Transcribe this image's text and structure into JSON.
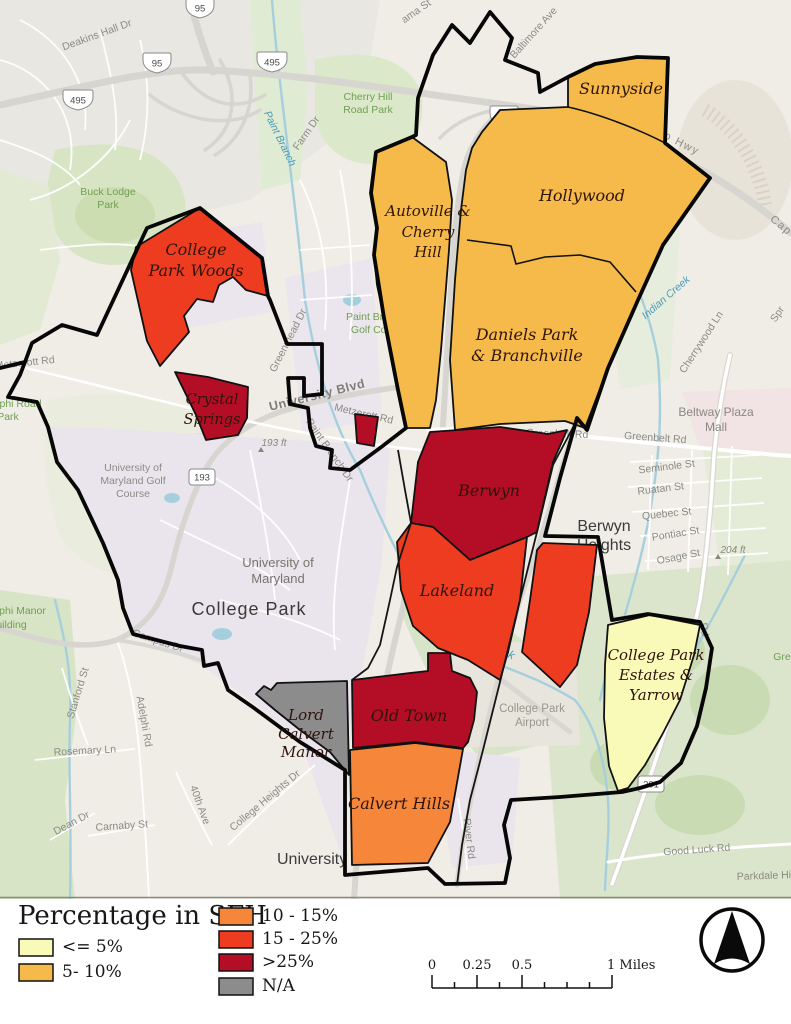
{
  "colors": {
    "cat_le5": "#FAFAB8",
    "cat_5_10": "#F6BA4A",
    "cat_10_15": "#F6873A",
    "cat_15_25": "#EE3C20",
    "cat_gt25": "#B30E26",
    "cat_na": "#8C8C8C"
  },
  "neighborhoods": {
    "sunnyside": "Sunnyside",
    "hollywood": "Hollywood",
    "autoville": [
      "Autoville &",
      "Cherry",
      "Hill"
    ],
    "daniels": [
      "Daniels Park",
      "& Branchville"
    ],
    "cp_woods": [
      "College",
      "Park Woods"
    ],
    "crystal_springs": [
      "Crystal",
      "Springs"
    ],
    "berwyn": "Berwyn",
    "lakeland": "Lakeland",
    "cpe_yarrow": [
      "College Park",
      "Estates &",
      "Yarrow"
    ],
    "lord_calvert": [
      "Lord",
      "Calvert",
      "Manor"
    ],
    "old_town": "Old Town",
    "calvert_hills": "Calvert Hills"
  },
  "roads": {
    "deakins": "Deakins Hall Dr",
    "farm": "Farm Dr",
    "baltimore": "Baltimore Ave",
    "ama_st": "ama St",
    "cap_belt": "Cap Belt Ol So Hwy",
    "cap": "Cap",
    "metzerott": "Metzerott Rd",
    "university_blvd": "University Blvd",
    "greenmead": "Greenmead Dr",
    "paint_branch_dr": "Paint Branch Dr",
    "greenbelt": "Greenbelt Rd",
    "cherrywood": "Cherrywood Ln",
    "spr": "Spr",
    "seminole": "Seminole St",
    "ruatan": "Ruatan St",
    "quebec": "Quebec St",
    "pontiac": "Pontiac St",
    "osage": "Osage St",
    "campus_dr": "Campus Dr",
    "stanford": "Stanford St",
    "adelphi_rd": "Adelphi Rd",
    "rosemary": "Rosemary Ln",
    "dean": "Dean Dr",
    "carnaby": "Carnaby St",
    "ave40": "40th Ave",
    "college_heights": "College Heights Dr",
    "river_rd": "River Rd",
    "good_luck": "Good Luck Rd",
    "rd": "Rd"
  },
  "places": {
    "buck_lodge": [
      "Buck Lodge",
      "Park"
    ],
    "cherry_hill_park": [
      "Cherry Hill",
      "Road Park"
    ],
    "pb_golf": [
      "Paint Branch",
      "Golf Comp"
    ],
    "adelphi_park": [
      "Adelphi Road",
      "Park"
    ],
    "golf_course": [
      "University of",
      "Maryland Golf",
      "Course"
    ],
    "umd": [
      "University of",
      "Maryland"
    ],
    "college_park": "College Park",
    "berwyn_heights": [
      "Berwyn",
      "Heights"
    ],
    "beltway_plaza": [
      "Beltway Plaza",
      "Mall"
    ],
    "airport": [
      "College Park",
      "Airport"
    ],
    "adelphi_manor": [
      "Adelphi Manor",
      "Building"
    ],
    "university_park": "University P",
    "parkdale": "Parkdale Hi",
    "gre": "Gre"
  },
  "water": {
    "paint_branch": "Paint Branch",
    "indian_creek": "Indian Creek",
    "pb_creek": "Paint Branch Creek"
  },
  "elevation": {
    "e193": "193 ft",
    "e204": "204 ft"
  },
  "shields": {
    "i95": "95",
    "i495": "495",
    "md193": "193",
    "md201": "201"
  },
  "legend": {
    "title": "Percentage in SFH",
    "items": [
      {
        "label": "<= 5%",
        "color": "#FAFAB8"
      },
      {
        "label": "5- 10%",
        "color": "#F6BA4A"
      },
      {
        "label": "10 - 15%",
        "color": "#F6873A"
      },
      {
        "label": "15 - 25%",
        "color": "#EE3C20"
      },
      {
        "label": ">25%",
        "color": "#B30E26"
      },
      {
        "label": "N/A",
        "color": "#8C8C8C"
      }
    ]
  },
  "scalebar": {
    "t0": "0",
    "t025": "0.25",
    "t05": "0.5",
    "t1": "1 Miles"
  }
}
